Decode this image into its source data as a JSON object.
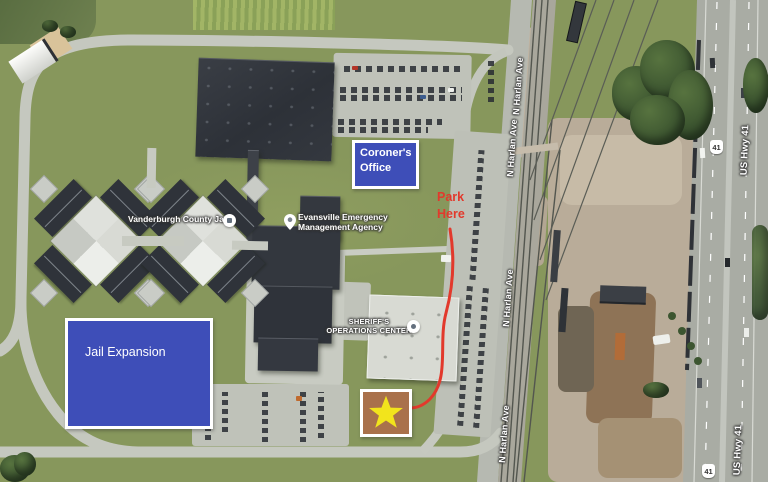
{
  "annotations": {
    "coroners_office": {
      "line1": "Coroner's",
      "line2": "Office"
    },
    "jail_expansion": {
      "label": "Jail Expansion"
    },
    "park_here": {
      "line1": "Park",
      "line2": "Here"
    },
    "colors": {
      "annotation_blue": "#3e4eb8",
      "annotation_border": "#ffffff",
      "park_here_red": "#e2392c",
      "star_yellow": "#f2e41c",
      "star_box_brown": "#a9714b"
    }
  },
  "map_labels": {
    "jail_poi": "Vanderburgh County Jail",
    "ema_line1": "Evansville Emergency",
    "ema_line2": "Management Agency",
    "sheriff_line1": "SHERIFF'S",
    "sheriff_line2": "OPERATIONS CENTER",
    "street_harlan": "N Harlan Ave",
    "street_hwy": "US Hwy 41",
    "shield": "41"
  }
}
